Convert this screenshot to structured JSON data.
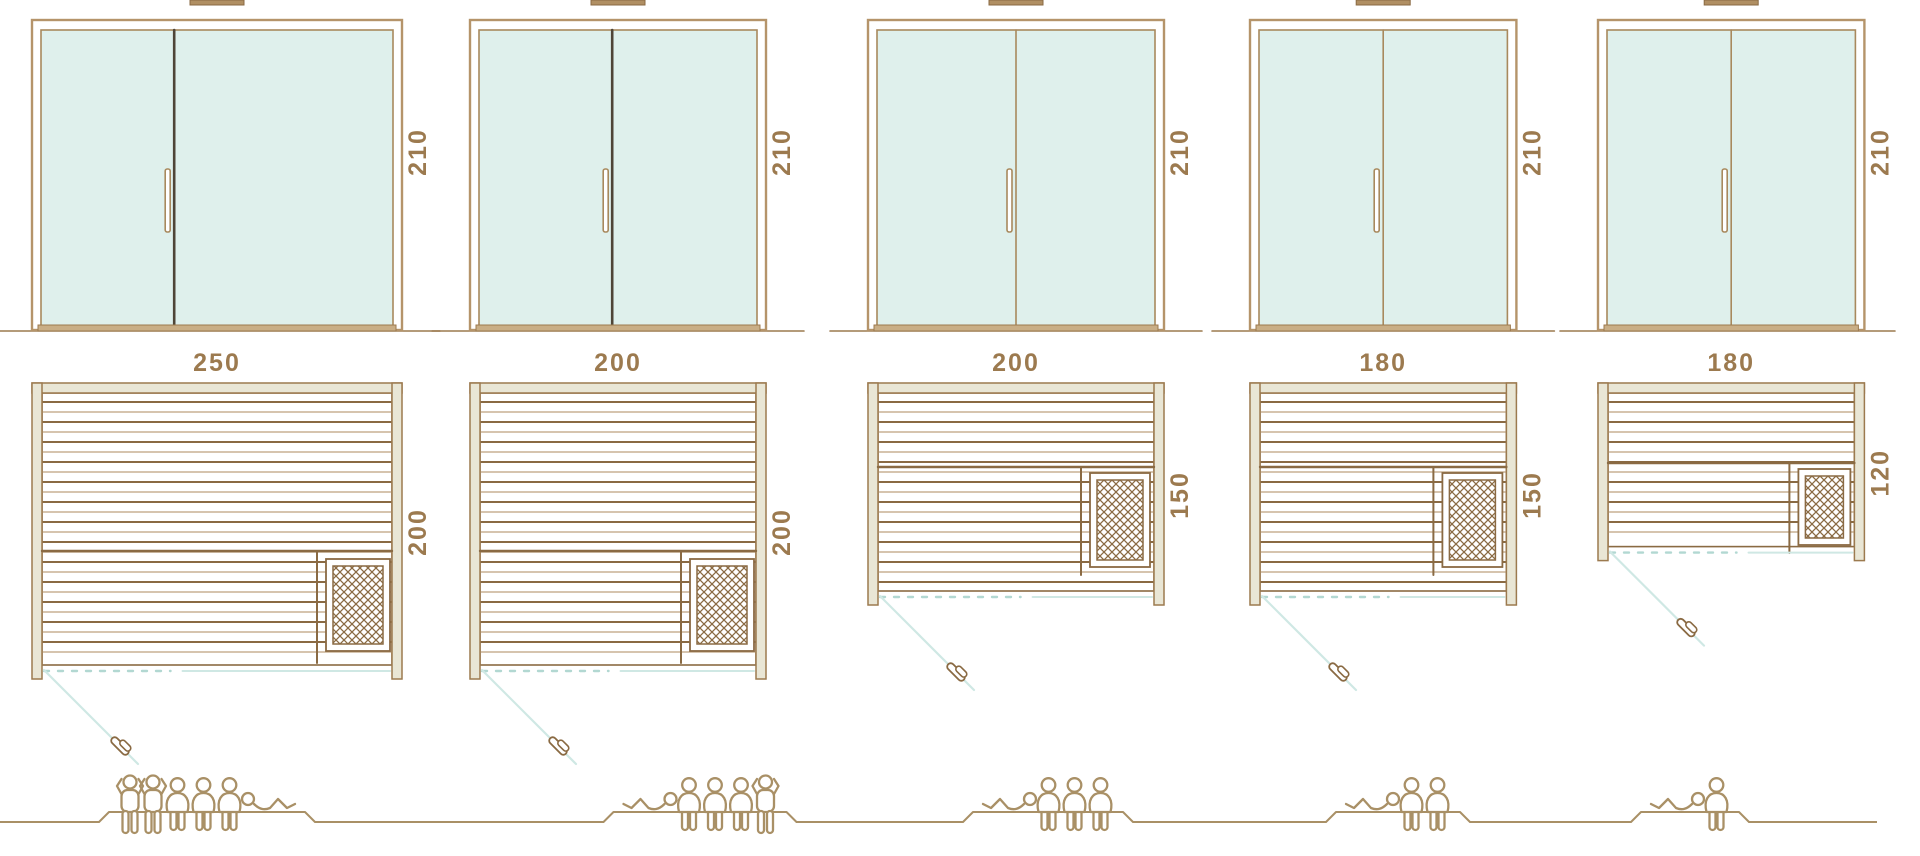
{
  "diagram_type": "sauna-size-comparison",
  "colors": {
    "background": "#ffffff",
    "brown_dark": "#8a6a43",
    "brown_mid": "#9c7a4f",
    "brown_light": "#c9b193",
    "frame": "#b5946a",
    "frame_inner": "#a8895d",
    "beige_wall": "#e9e6d5",
    "glass": "#dff0ec",
    "divider_dark": "#4f4537",
    "teal_solid": "#cfe8e4",
    "teal_dash": "#b2d8d2",
    "people": "#a99066",
    "sill": "#c9ae86",
    "cap": "#b08f63",
    "label_text": "#9c7a4f"
  },
  "models": [
    {
      "door": {
        "height_label": "210",
        "height_cm": 210,
        "divider": "offset",
        "leaf_cm": 90
      },
      "plan": {
        "width_label": "250",
        "width_cm": 250,
        "depth_label": "200",
        "depth_cm": 200,
        "heater": "bottom-right"
      },
      "capacity": {
        "total": 6,
        "figures": [
          "standing",
          "standing",
          "sitting",
          "sitting",
          "sitting",
          "lying-right"
        ]
      }
    },
    {
      "door": {
        "height_label": "210",
        "height_cm": 210,
        "divider": "offset",
        "leaf_cm": 90
      },
      "plan": {
        "width_label": "200",
        "width_cm": 200,
        "depth_label": "200",
        "depth_cm": 200,
        "heater": "bottom-right"
      },
      "capacity": {
        "total": 5,
        "figures": [
          "lying-left",
          "sitting",
          "sitting",
          "sitting",
          "standing"
        ]
      }
    },
    {
      "door": {
        "height_label": "210",
        "height_cm": 210,
        "divider": "center",
        "leaf_cm": 100
      },
      "plan": {
        "width_label": "200",
        "width_cm": 200,
        "depth_label": "150",
        "depth_cm": 150,
        "heater": "right"
      },
      "capacity": {
        "total": 4,
        "figures": [
          "lying-left",
          "sitting",
          "sitting",
          "sitting"
        ]
      }
    },
    {
      "door": {
        "height_label": "210",
        "height_cm": 210,
        "divider": "center",
        "leaf_cm": 90
      },
      "plan": {
        "width_label": "180",
        "width_cm": 180,
        "depth_label": "150",
        "depth_cm": 150,
        "heater": "right"
      },
      "capacity": {
        "total": 3,
        "figures": [
          "lying-left",
          "sitting",
          "sitting"
        ]
      }
    },
    {
      "door": {
        "height_label": "210",
        "height_cm": 210,
        "divider": "center",
        "leaf_cm": 90
      },
      "plan": {
        "width_label": "180",
        "width_cm": 180,
        "depth_label": "120",
        "depth_cm": 120,
        "heater": "right-small"
      },
      "capacity": {
        "total": 2,
        "figures": [
          "lying-left",
          "sitting"
        ]
      }
    }
  ]
}
